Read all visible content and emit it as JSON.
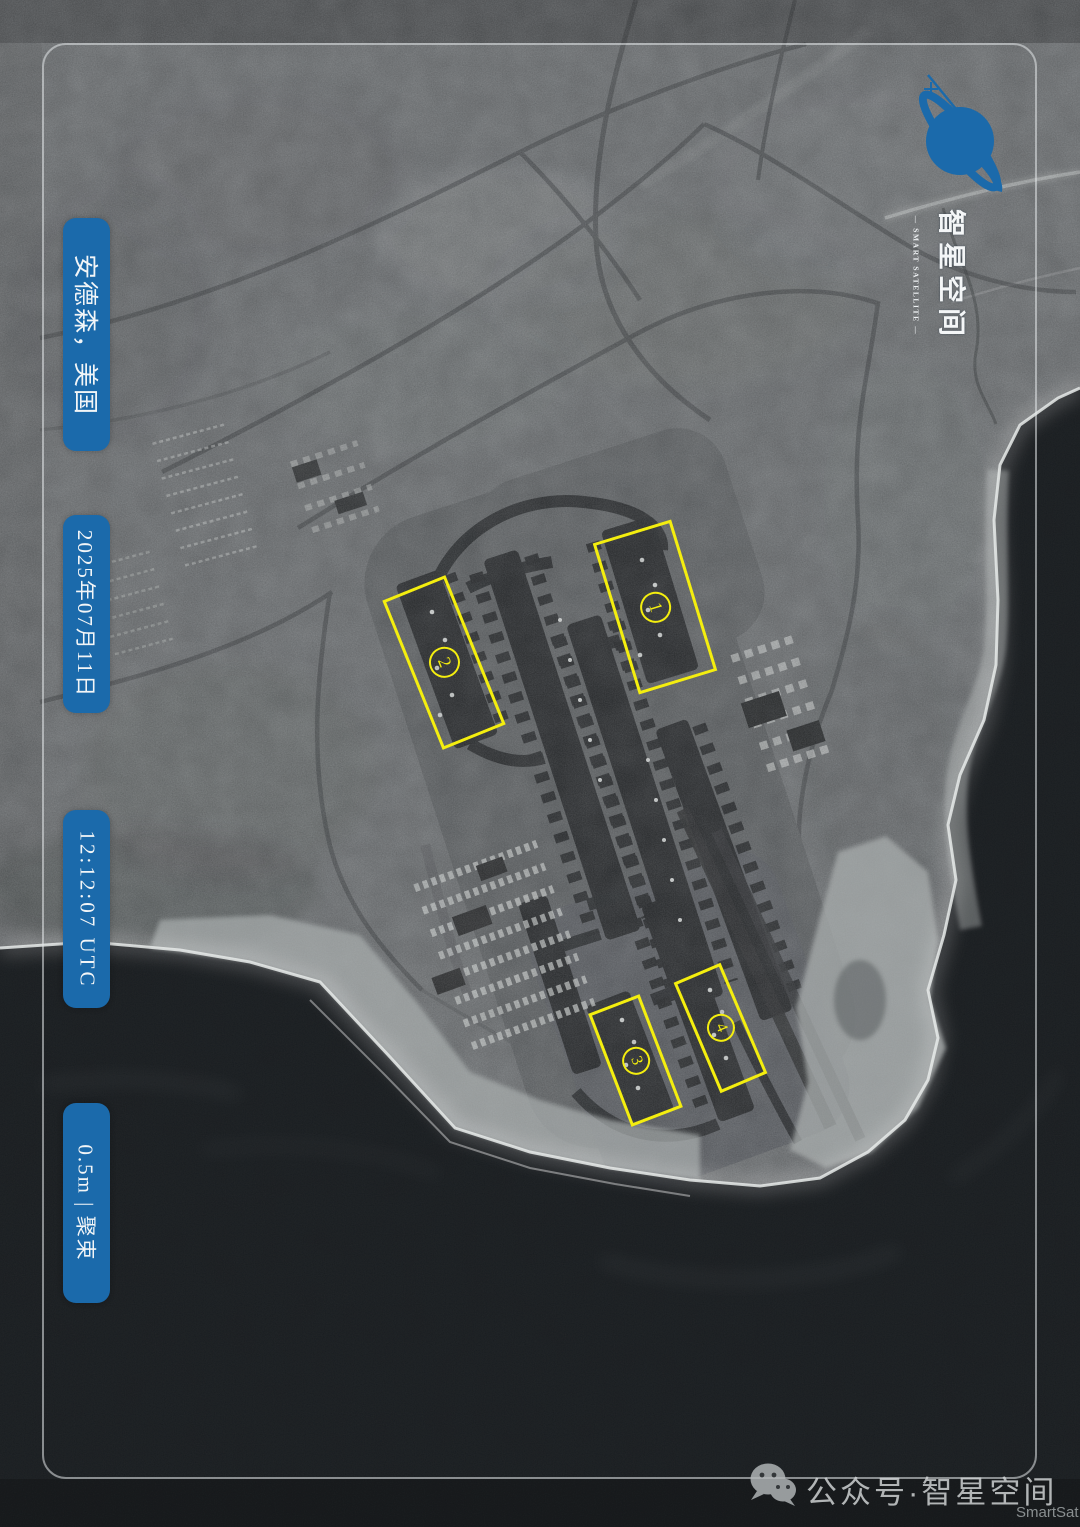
{
  "labels": [
    {
      "id": "location",
      "text": "安德森，美国"
    },
    {
      "id": "date",
      "text": "2025年07月11日"
    },
    {
      "id": "time",
      "text": "12:12:07 UTC"
    },
    {
      "id": "mode",
      "text": "0.5m | 聚束"
    }
  ],
  "logo": {
    "cn": "智星空间",
    "en": "— SMART SATELLITE —"
  },
  "annotations": [
    {
      "num": "1"
    },
    {
      "num": "2"
    },
    {
      "num": "3"
    },
    {
      "num": "4"
    }
  ],
  "watermark": {
    "account": "公众号·智星空间",
    "brand": "SmartSat"
  },
  "colors": {
    "label_blue": "#1b6aab",
    "annotation_yellow": "#f4ee0f",
    "land_gray": "#74787b",
    "ocean_dark": "#14171a",
    "coast_white": "#e8ebea"
  }
}
